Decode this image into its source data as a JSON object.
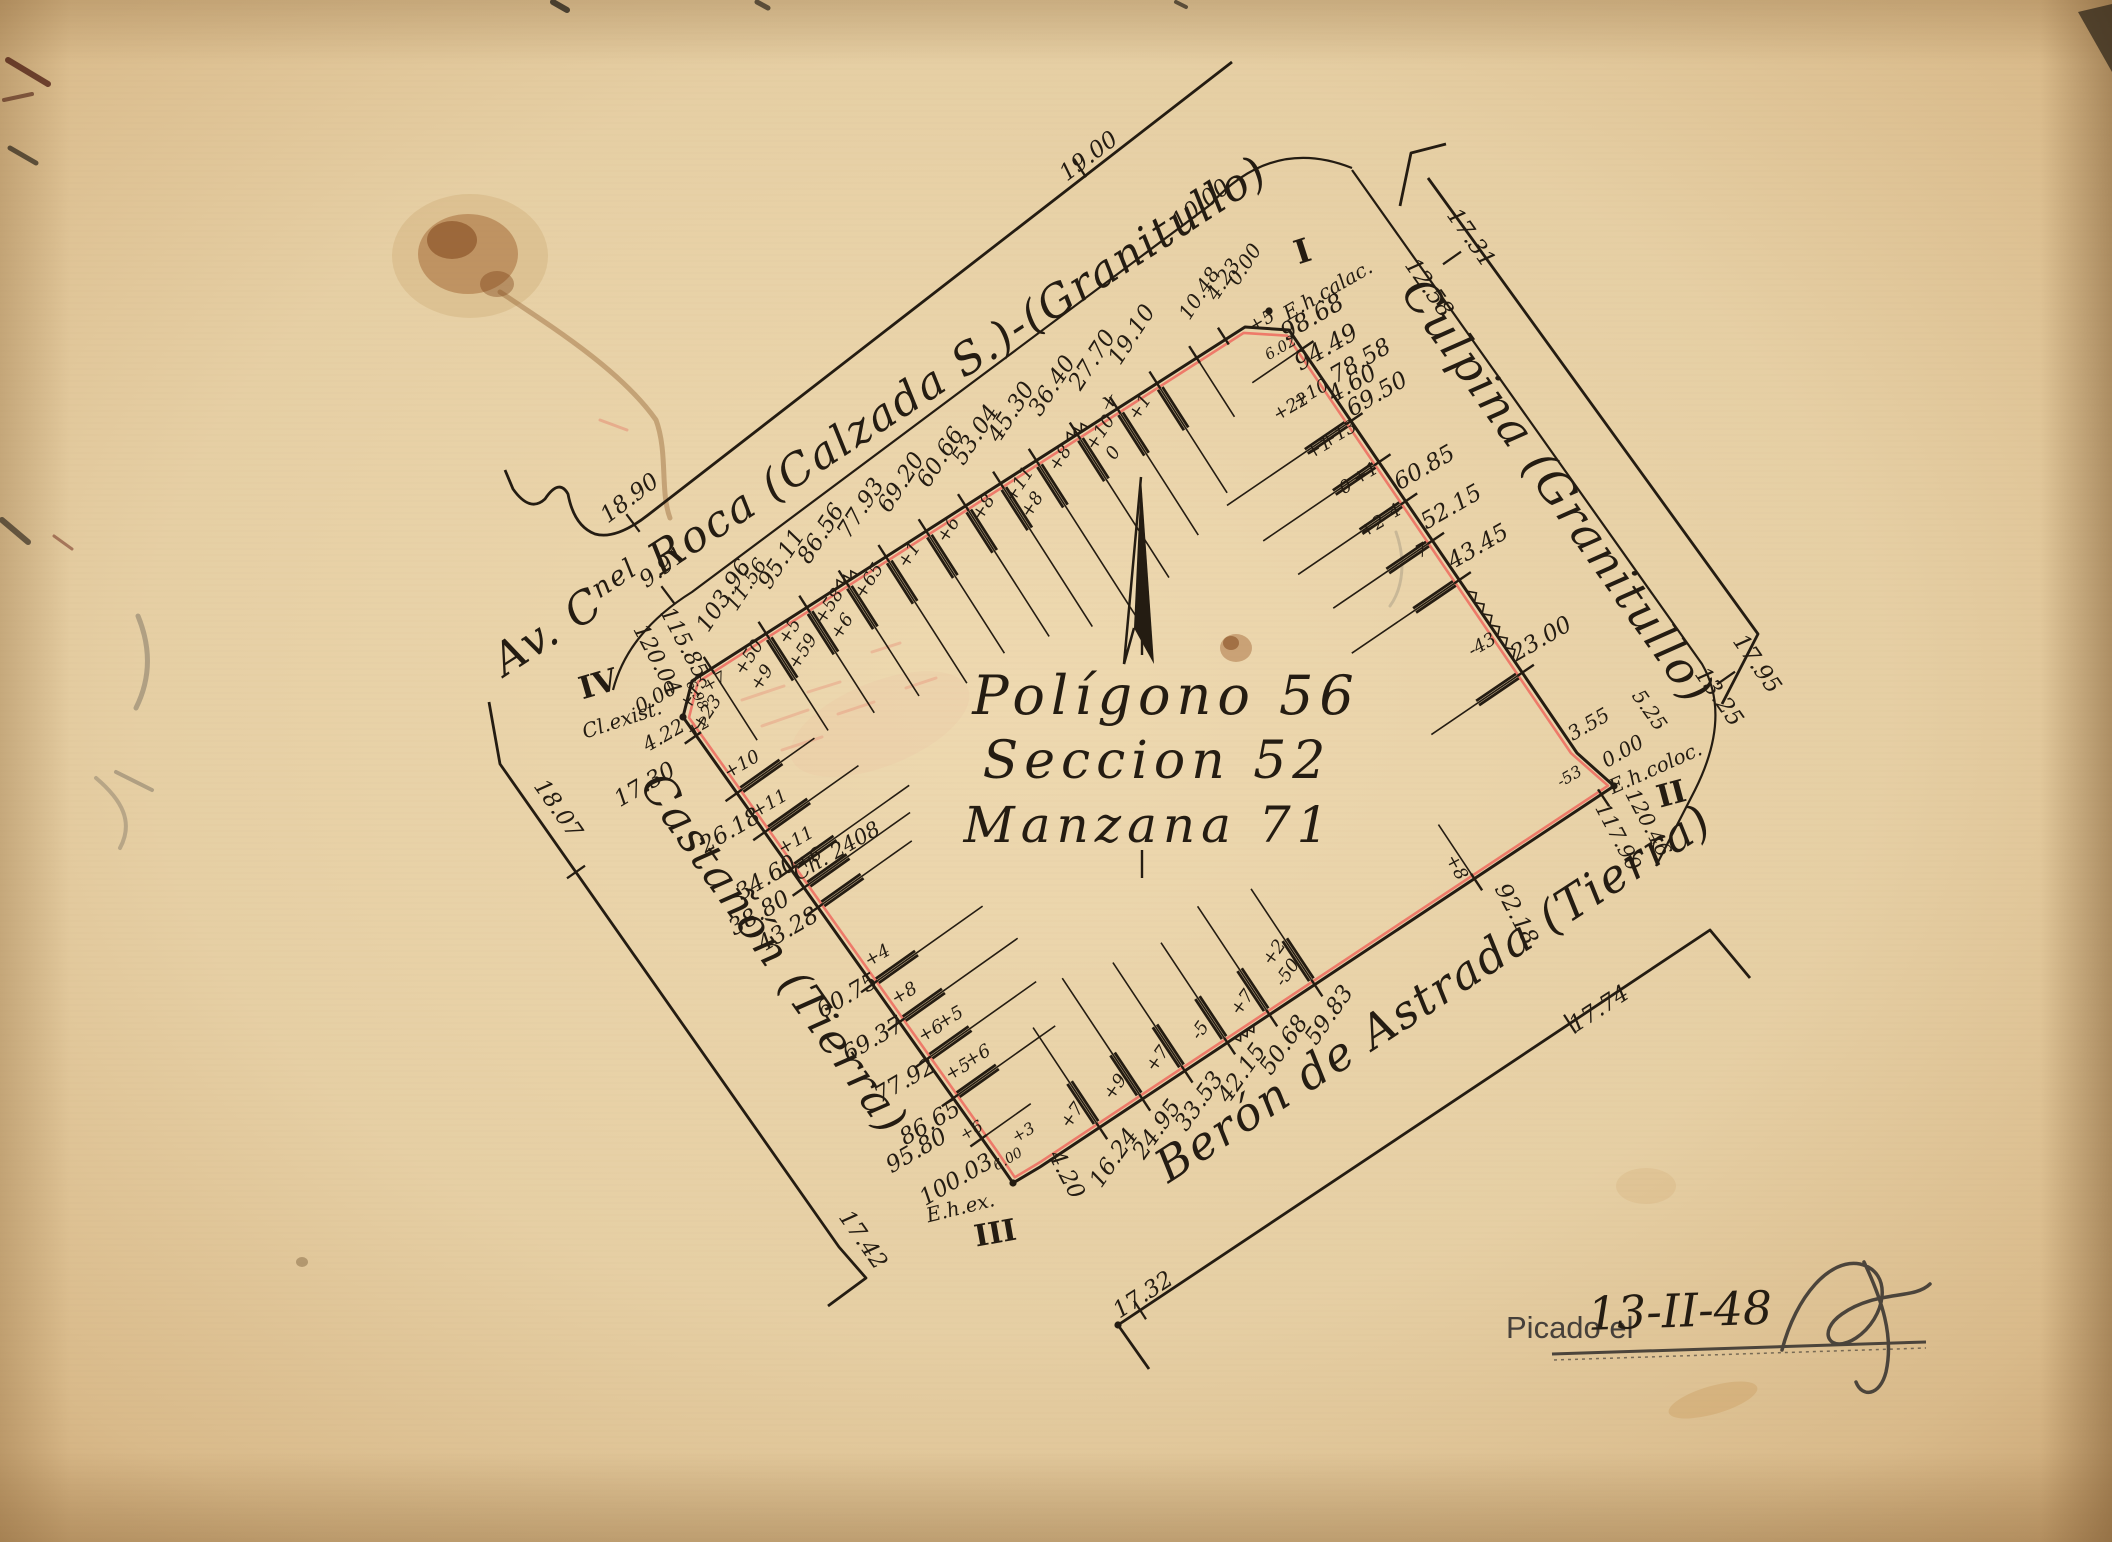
{
  "palette": {
    "paper": "#ead5ab",
    "paper_edge": "#cca878",
    "ink": "#241c12",
    "red_line": "#ef6a5e",
    "red_text": "#d84a3a",
    "pencil": "#4b443b"
  },
  "title_block": {
    "line1": "Polígono 56",
    "line2": "Seccion 52",
    "line3": "Manzana 71"
  },
  "date_block": {
    "label": "Picado el",
    "date": "13-II-48"
  },
  "street_names": [
    {
      "id": "av-roca",
      "parts": [
        {
          "t": "Av. C"
        },
        {
          "t": "nel",
          "sup": true
        },
        {
          "t": " Roca (Calzada S.)-(Granitullo)"
        }
      ],
      "x": 888,
      "y": 428,
      "rot": -33,
      "size": 44
    },
    {
      "id": "culpina",
      "parts": [
        {
          "t": "Culpina (Granitullo)"
        }
      ],
      "x": 1545,
      "y": 500,
      "rot": 55,
      "size": 46
    },
    {
      "id": "castanon",
      "parts": [
        {
          "t": "Castañón (Tierra)"
        }
      ],
      "x": 762,
      "y": 962,
      "rot": 55,
      "size": 44
    },
    {
      "id": "beron",
      "parts": [
        {
          "t": "Berón de Astrada (Tierra)"
        }
      ],
      "x": 1442,
      "y": 1006,
      "rot": -33,
      "size": 46
    }
  ],
  "boundary": [
    [
      1245,
      327
    ],
    [
      692,
      681
    ],
    [
      683,
      717
    ],
    [
      995,
      1157
    ],
    [
      1013,
      1183
    ],
    [
      1040,
      1167
    ],
    [
      1614,
      786
    ],
    [
      1596,
      770
    ],
    [
      1577,
      753
    ],
    [
      1289,
      330
    ]
  ],
  "corner_dots": [
    [
      1269,
      311
    ],
    [
      1614,
      786
    ],
    [
      1013,
      1183
    ],
    [
      683,
      717
    ],
    [
      1118,
      1325
    ]
  ],
  "street_lines": [
    {
      "id": "roca-outer",
      "d": "M 1232,62 L 648,515 Q 616,540 595,534 Q 574,526 568,494 Q 559,478 545,499 Q 530,513 513,489 L 505,470",
      "w": 2.8
    },
    {
      "id": "roca-inner",
      "d": "M 1352,168 Q 1272,136 1210,205 L 692,592 Q 628,632 613,690",
      "w": 2.2
    },
    {
      "id": "culpina-bracket",
      "d": "M 1400,206 L 1411,153 L 1446,144",
      "w": 2.8
    },
    {
      "id": "culpina-outer",
      "d": "M 1428,178 L 1758,634 L 1722,704",
      "w": 2.8
    },
    {
      "id": "culpina-inner",
      "d": "M 1352,170 L 1702,664 Q 1732,716 1695,790 L 1656,866",
      "w": 2.2
    },
    {
      "id": "castanon-outer",
      "d": "M 489,702 L 500,764 L 839,1247 L 866,1278 L 828,1306",
      "w": 2.8
    },
    {
      "id": "beron-outer",
      "d": "M 1149,1369 L 1118,1325 L 1710,930 L 1750,978",
      "w": 2.8
    }
  ],
  "edges": [
    {
      "name": "roca",
      "from": [
        1245,
        327
      ],
      "to": [
        692,
        681
      ],
      "v0": 0,
      "v1": 120.04,
      "cfg": {
        "d": 48,
        "s": -8,
        "rot": -57,
        "offIn": 16,
        "offAlong": 25
      },
      "ticks": [
        {
          "v": 4.23,
          "nl": 1
        },
        {
          "v": 10.48,
          "nl": 1,
          "L": 70
        },
        {
          "v": 19.1,
          "L": 130,
          "off": [
            "+1"
          ]
        },
        {
          "v": 27.7,
          "L": 150,
          "off": [
            "+10",
            "0"
          ]
        },
        {
          "v": 36.4,
          "L": 170,
          "off": [
            "+8"
          ]
        },
        {
          "v": 45.3,
          "L": 190,
          "off": [
            "+11",
            "+8"
          ]
        },
        {
          "v": 53.04,
          "L": 170,
          "off": [
            "+8"
          ]
        },
        {
          "v": 60.66,
          "L": 155,
          "off": [
            "+6"
          ]
        },
        {
          "v": 69.2,
          "L": 145,
          "off": [
            "+1"
          ]
        },
        {
          "v": 77.93,
          "L": 150,
          "off": [
            "+65"
          ]
        },
        {
          "v": 86.56,
          "L": 135,
          "off": [
            "+58",
            "+6"
          ]
        },
        {
          "v": 95.11,
          "L": 125,
          "off": [
            "+5",
            "+59"
          ]
        },
        {
          "v": 103.96,
          "L": 115,
          "s": 12,
          "off": [
            "+50",
            "+9"
          ]
        },
        {
          "v": 115.85,
          "nl": 1,
          "L": 85,
          "off": [
            "+13",
            "+23"
          ]
        }
      ]
    },
    {
      "name": "castanon",
      "from": [
        683,
        717
      ],
      "to": [
        995,
        1157
      ],
      "v0": 0,
      "v1": 100.03,
      "cfg": {
        "d": 32,
        "s": 6,
        "rot": -30,
        "offIn": 20,
        "offAlong": -15
      },
      "ticks": [
        {
          "v": 4.22,
          "nl": 1
        },
        {
          "v": 17.3,
          "d": 71,
          "s": -53,
          "L": 95,
          "off": [
            "+10"
          ]
        },
        {
          "v": 26.18,
          "d": 28,
          "s": -14,
          "L": 115,
          "off": [
            "+11"
          ]
        },
        {
          "v": 34.6,
          "d": 26,
          "s": 0,
          "L": 145,
          "off": [
            "+11"
          ]
        },
        {
          "v": 38.8,
          "d": 52,
          "s": 2,
          "L": 130,
          "off": [
            "+6"
          ]
        },
        {
          "v": 43.28,
          "d": 38,
          "s": 8,
          "L": 115
        },
        {
          "v": 60.75,
          "d": 28,
          "s": 2,
          "L": 135,
          "off": [
            "+4"
          ]
        },
        {
          "v": 69.37,
          "L": 145,
          "off": [
            "+8"
          ]
        },
        {
          "v": 77.92,
          "d": 30,
          "s": 12,
          "L": 135,
          "off": [
            "+6",
            "+5"
          ]
        },
        {
          "v": 86.65,
          "d": 34,
          "s": 14,
          "L": 125,
          "off": [
            "+5",
            "+6"
          ]
        },
        {
          "v": 95.8,
          "nl": 1,
          "L": 60
        }
      ]
    },
    {
      "name": "beron",
      "from": [
        1040,
        1167
      ],
      "to": [
        1614,
        786
      ],
      "v0": 4.2,
      "v1": 120.46,
      "cfg": {
        "d": 40,
        "s": -2,
        "rot": -55,
        "offIn": 20,
        "offAlong": -14
      },
      "ticks": [
        {
          "v": 16.24,
          "L": 120,
          "off": [
            "+7"
          ]
        },
        {
          "v": 24.95,
          "L": 145,
          "off": [
            "+9"
          ]
        },
        {
          "v": 33.53,
          "L": 130,
          "off": [
            "+7"
          ]
        },
        {
          "v": 42.15,
          "L": 120,
          "off": [
            "-5"
          ]
        },
        {
          "v": 50.68,
          "L": 130,
          "off": [
            "+7"
          ]
        },
        {
          "v": 59.83,
          "L": 115,
          "off": [
            "-50",
            "+2"
          ]
        },
        {
          "v": 92.18,
          "d": 52,
          "s": 8,
          "lr": 62,
          "L": 65,
          "off": [
            "+8"
          ]
        },
        {
          "v": 117.9,
          "nl": 1
        }
      ]
    },
    {
      "name": "culpina",
      "from": [
        1577,
        753
      ],
      "to": [
        1289,
        330
      ],
      "v0": 5.25,
      "v1": 98.68,
      "cfg": {
        "d": 34,
        "s": 10,
        "rot": -30,
        "offIn": 18,
        "offAlong": 40
      },
      "ticks": [
        {
          "v": 23.0,
          "L": 110,
          "off": [
            "-43"
          ]
        },
        {
          "v": 43.45,
          "L": 130,
          "off": [
            "-7"
          ]
        },
        {
          "v": 52.15,
          "L": 120,
          "off": [
            "-4",
            "+2"
          ]
        },
        {
          "v": 60.85,
          "L": 130,
          "off": [
            "+1",
            "0"
          ]
        },
        {
          "v": 69.5,
          "d": 36,
          "s": 50,
          "L": 140,
          "off": [
            "+13",
            "+1"
          ]
        },
        {
          "v": 78.58,
          "d": 41,
          "s": 37,
          "L": 150,
          "off": [
            "+10",
            "+22"
          ]
        },
        {
          "v": 94.49,
          "nl": 1,
          "L": 60,
          "off": [
            "+5"
          ]
        }
      ]
    }
  ],
  "zigzags": [
    {
      "e": "roca",
      "a": 34,
      "b": 38.5,
      "amp": 7
    },
    {
      "e": "roca",
      "a": 84,
      "b": 88.5,
      "amp": 7
    },
    {
      "e": "culpina",
      "a": 26,
      "b": 41,
      "amp": 7
    },
    {
      "e": "beron",
      "a": 43.5,
      "b": 47.5,
      "amp": 6
    }
  ],
  "annotations": [
    {
      "t": "I",
      "x": 1306,
      "y": 262,
      "r": -18,
      "s": 33,
      "cls": "roman"
    },
    {
      "t": "E.h.calac.",
      "x": 1331,
      "y": 296,
      "r": -30,
      "s": 20
    },
    {
      "t": "98.68",
      "x": 1316,
      "y": 324,
      "r": -30,
      "s": 24
    },
    {
      "t": "94.49",
      "x": 1330,
      "y": 354,
      "r": -30,
      "s": 24
    },
    {
      "t": "4.60",
      "x": 1356,
      "y": 390,
      "r": -30,
      "s": 23
    },
    {
      "t": "0.00",
      "x": 1250,
      "y": 268,
      "r": -57,
      "s": 20
    },
    {
      "t": "4.23",
      "x": 1229,
      "y": 283,
      "r": -57,
      "s": 20
    },
    {
      "t": "10.48",
      "x": 1205,
      "y": 297,
      "r": -57,
      "s": 20
    },
    {
      "t": "6.02",
      "x": 1283,
      "y": 352,
      "r": -30,
      "s": 15,
      "c": "#d84a3a"
    },
    {
      "t": "II",
      "x": 1674,
      "y": 804,
      "r": -15,
      "s": 31,
      "cls": "roman"
    },
    {
      "t": "E.h.coloc.",
      "x": 1658,
      "y": 774,
      "r": -24,
      "s": 20
    },
    {
      "t": "0.00",
      "x": 1626,
      "y": 757,
      "r": -30,
      "s": 20
    },
    {
      "t": "3.55",
      "x": 1592,
      "y": 730,
      "r": -30,
      "s": 20
    },
    {
      "t": "5.25",
      "x": 1644,
      "y": 714,
      "r": 55,
      "s": 20
    },
    {
      "t": "120.46",
      "x": 1642,
      "y": 826,
      "r": 62,
      "s": 21
    },
    {
      "t": "117.90",
      "x": 1612,
      "y": 840,
      "r": 62,
      "s": 21
    },
    {
      "t": "-53",
      "x": 1572,
      "y": 781,
      "r": -30,
      "s": 16
    },
    {
      "t": "III",
      "x": 997,
      "y": 1243,
      "r": -10,
      "s": 30,
      "cls": "roman"
    },
    {
      "t": "E.h.ex.",
      "x": 962,
      "y": 1214,
      "r": -14,
      "s": 20
    },
    {
      "t": "100.03",
      "x": 960,
      "y": 1186,
      "r": -30,
      "s": 23
    },
    {
      "t": "95.80",
      "x": 920,
      "y": 1157,
      "r": -30,
      "s": 23
    },
    {
      "t": "4.20",
      "x": 1060,
      "y": 1178,
      "r": 62,
      "s": 23
    },
    {
      "t": "6.00",
      "x": 1010,
      "y": 1163,
      "r": -30,
      "s": 14,
      "c": "#d84a3a"
    },
    {
      "t": "+6",
      "x": 974,
      "y": 1135,
      "r": -30,
      "s": 16
    },
    {
      "t": "+3",
      "x": 1026,
      "y": 1137,
      "r": -30,
      "s": 16
    },
    {
      "t": "IV",
      "x": 601,
      "y": 694,
      "r": -16,
      "s": 31,
      "cls": "roman"
    },
    {
      "t": "Cl.exist.",
      "x": 624,
      "y": 726,
      "r": -18,
      "s": 20
    },
    {
      "t": "0.00",
      "x": 659,
      "y": 703,
      "r": -30,
      "s": 20
    },
    {
      "t": "120.04",
      "x": 651,
      "y": 663,
      "r": 62,
      "s": 22
    },
    {
      "t": "115.85",
      "x": 678,
      "y": 646,
      "r": 62,
      "s": 22
    },
    {
      "t": "4.22",
      "x": 667,
      "y": 741,
      "r": -30,
      "s": 20
    },
    {
      "t": "+2",
      "x": 701,
      "y": 731,
      "r": -30,
      "s": 16
    },
    {
      "t": "6.98",
      "x": 693,
      "y": 697,
      "r": 62,
      "s": 14,
      "c": "#d84a3a"
    },
    {
      "t": "+7",
      "x": 717,
      "y": 686,
      "r": -30,
      "s": 16
    },
    {
      "t": "Ch. 2408",
      "x": 840,
      "y": 857,
      "r": -30,
      "s": 21
    },
    {
      "t": "11.56",
      "x": 752,
      "y": 588,
      "r": -57,
      "s": 20
    },
    {
      "t": "19.00",
      "x": 1093,
      "y": 162,
      "r": -37,
      "s": 23
    },
    {
      "t": "10.00",
      "x": 1205,
      "y": 210,
      "r": -37,
      "s": 23
    },
    {
      "t": "18.90",
      "x": 634,
      "y": 504,
      "r": -37,
      "s": 23
    },
    {
      "t": "9.91",
      "x": 667,
      "y": 573,
      "r": -37,
      "s": 23
    },
    {
      "t": "17.31",
      "x": 1465,
      "y": 242,
      "r": 55,
      "s": 23
    },
    {
      "t": "12.58",
      "x": 1423,
      "y": 292,
      "r": 55,
      "s": 23
    },
    {
      "t": "17.95",
      "x": 1751,
      "y": 668,
      "r": 55,
      "s": 23
    },
    {
      "t": "13.25",
      "x": 1713,
      "y": 701,
      "r": 55,
      "s": 23
    },
    {
      "t": "18.07",
      "x": 552,
      "y": 813,
      "r": 55,
      "s": 23
    },
    {
      "t": "17.42",
      "x": 857,
      "y": 1244,
      "r": 55,
      "s": 23
    },
    {
      "t": "17.74",
      "x": 1603,
      "y": 1015,
      "r": -33,
      "s": 23
    },
    {
      "t": "17.32",
      "x": 1147,
      "y": 1301,
      "r": -33,
      "s": 23
    },
    {
      "t": "x",
      "x": 1111,
      "y": 407,
      "r": -20,
      "s": 22,
      "c": "#6b6157"
    }
  ],
  "cross_ticks": [
    {
      "x": 633,
      "y": 523,
      "a": 53
    },
    {
      "x": 668,
      "y": 595,
      "a": 53
    },
    {
      "x": 1080,
      "y": 168,
      "a": 57
    },
    {
      "x": 1452,
      "y": 258,
      "a": -35
    },
    {
      "x": 1726,
      "y": 678,
      "a": -35
    },
    {
      "x": 576,
      "y": 872,
      "a": -35
    },
    {
      "x": 1570,
      "y": 1024,
      "a": 57
    },
    {
      "x": 1140,
      "y": 1310,
      "a": 57
    }
  ],
  "fold_ticks": [
    [
      1142,
      628,
      1142,
      655
    ],
    [
      1142,
      850,
      1142,
      878
    ]
  ],
  "signature": {
    "strokes": "M 1782,1350 C 1796,1296 1830,1258 1860,1264 C 1894,1272 1886,1318 1856,1338 C 1830,1355 1816,1332 1842,1314 C 1876,1290 1914,1300 1930,1284 M 1864,1262 C 1882,1300 1894,1336 1886,1372 C 1880,1396 1862,1398 1856,1382",
    "underline1": "M 1552,1354 L 1926,1342",
    "underline2": "M 1554,1360 L 1926,1348"
  },
  "stains": [
    {
      "sh": "e",
      "x": 470,
      "y": 256,
      "rx": 78,
      "ry": 62,
      "f": "#b98a4a",
      "o": 0.2
    },
    {
      "sh": "e",
      "x": 468,
      "y": 254,
      "rx": 50,
      "ry": 40,
      "f": "#9c5a28",
      "o": 0.45
    },
    {
      "sh": "e",
      "x": 452,
      "y": 240,
      "rx": 25,
      "ry": 19,
      "f": "#7a3d14",
      "o": 0.5
    },
    {
      "sh": "e",
      "x": 497,
      "y": 284,
      "rx": 17,
      "ry": 13,
      "f": "#7a3d14",
      "o": 0.38
    },
    {
      "sh": "p",
      "d": "M 500,292 C 560,332 622,372 656,420 C 668,452 660,492 670,518",
      "st": "#8a5426",
      "w": 5,
      "o": 0.38
    },
    {
      "sh": "e",
      "x": 1236,
      "y": 648,
      "rx": 16,
      "ry": 14,
      "f": "#9c5a2a",
      "o": 0.42
    },
    {
      "sh": "e",
      "x": 1231,
      "y": 643,
      "rx": 8,
      "ry": 7,
      "f": "#7a3d14",
      "o": 0.5
    },
    {
      "sh": "e",
      "x": 1713,
      "y": 1400,
      "rx": 46,
      "ry": 14,
      "f": "#c08a46",
      "o": 0.26,
      "rot": -16
    },
    {
      "sh": "e",
      "x": 1646,
      "y": 1186,
      "rx": 30,
      "ry": 18,
      "f": "#c49354",
      "o": 0.16
    },
    {
      "sh": "e",
      "x": 302,
      "y": 1262,
      "rx": 6,
      "ry": 5,
      "f": "#6d532f",
      "o": 0.4
    },
    {
      "sh": "p",
      "d": "M 138,616 C 152,650 150,680 136,708",
      "st": "#6f675c",
      "w": 5,
      "o": 0.45
    },
    {
      "sh": "p",
      "d": "M 96,778 C 122,800 134,822 120,848",
      "st": "#6f675c",
      "w": 4,
      "o": 0.38
    },
    {
      "sh": "p",
      "d": "M 1396,532 C 1406,560 1403,588 1390,606",
      "st": "#847c70",
      "w": 3,
      "o": 0.32
    },
    {
      "sh": "p",
      "d": "M 8,60 L 48,84",
      "st": "#4a1a10",
      "w": 6,
      "o": 0.75
    },
    {
      "sh": "p",
      "d": "M 4,100 L 32,94",
      "st": "#4a1a10",
      "w": 4,
      "o": 0.6
    },
    {
      "sh": "p",
      "d": "M 10,148 L 36,163",
      "st": "#2b241a",
      "w": 5,
      "o": 0.7
    },
    {
      "sh": "p",
      "d": "M 2,520 L 28,542",
      "st": "#2b241a",
      "w": 6,
      "o": 0.65
    },
    {
      "sh": "p",
      "d": "M 54,536 L 72,549",
      "st": "#6a2318",
      "w": 3,
      "o": 0.5
    },
    {
      "sh": "p",
      "d": "M 116,772 L 152,790",
      "st": "#6f675c",
      "w": 4,
      "o": 0.45
    },
    {
      "sh": "p",
      "d": "M 553,2 L 567,10",
      "st": "#2b241a",
      "w": 6,
      "o": 0.8
    },
    {
      "sh": "p",
      "d": "M 757,2 L 768,8",
      "st": "#2b241a",
      "w": 5,
      "o": 0.7
    },
    {
      "sh": "p",
      "d": "M 1176,2 L 1186,7",
      "st": "#2b241a",
      "w": 4,
      "o": 0.7
    },
    {
      "sh": "pg",
      "pts": "2078,12 2112,4 2112,72",
      "f": "#382d1e",
      "o": 0.8
    },
    {
      "sh": "p",
      "d": "M 600,420 L 627,430",
      "st": "#e4574d",
      "w": 3,
      "o": 0.3
    },
    {
      "sh": "p",
      "d": "M 742,700 l 42,-14 M 762,726 l 46,-16 M 782,750 l 40,-13 M 808,692 l 32,-10 M 838,714 l 36,-12 M 872,652 l 28,-9 M 906,688 l 30,-10",
      "st": "#e4574d",
      "w": 3,
      "o": 0.22
    },
    {
      "sh": "e",
      "x": 880,
      "y": 724,
      "rx": 95,
      "ry": 42,
      "f": "#f0a396",
      "o": 0.1,
      "rot": -22
    }
  ]
}
